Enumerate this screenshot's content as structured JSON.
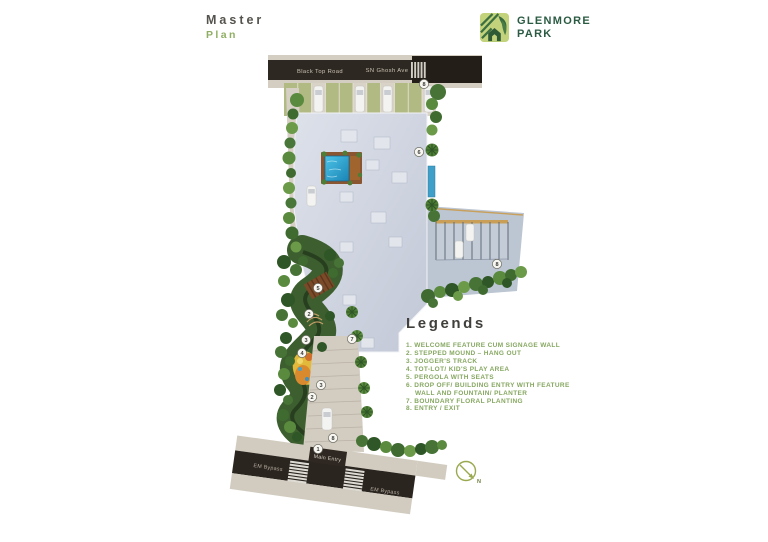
{
  "page": {
    "title_line1": "Master",
    "title_line2": "Plan"
  },
  "logo": {
    "line1": "GLENMORE",
    "line2": "PARK"
  },
  "map": {
    "road_top": {
      "label_left": "Black Top Road",
      "label_right": "SN Ghosh Ave"
    },
    "road_bottom": {
      "label_left": "EM Bypass",
      "label_center": "Main Entry",
      "label_right": "EM Bypass"
    },
    "markers": [
      "8",
      "6",
      "5",
      "2",
      "3",
      "4",
      "7",
      "3",
      "2",
      "8",
      "1",
      "8"
    ]
  },
  "legend": {
    "title": "Legends",
    "items": [
      "1. WELCOME FEATURE CUM SIGNAGE WALL",
      "2. STEPPED MOUND – HANG OUT",
      "3. JOGGER'S TRACK",
      "4. TOT-LOT/ KID'S PLAY AREA",
      "5. PERGOLA WITH SEATS",
      "6. DROP OFF/ BUILDING ENTRY WITH FEATURE WALL AND FOUNTAIN/ PLANTER",
      "7. BOUNDARY FLORAL PLANTING",
      "8. ENTRY / EXIT"
    ]
  },
  "compass": {
    "label": "N"
  },
  "colors": {
    "brand_green_dark": "#2b5b43",
    "brand_green_light": "#c3d37c",
    "legend_green": "#86a761",
    "title_gray": "#55534d",
    "road_asphalt": "#2e2822",
    "building_roof": "#ccd2de",
    "pool_blue": "#2fa8d5"
  }
}
